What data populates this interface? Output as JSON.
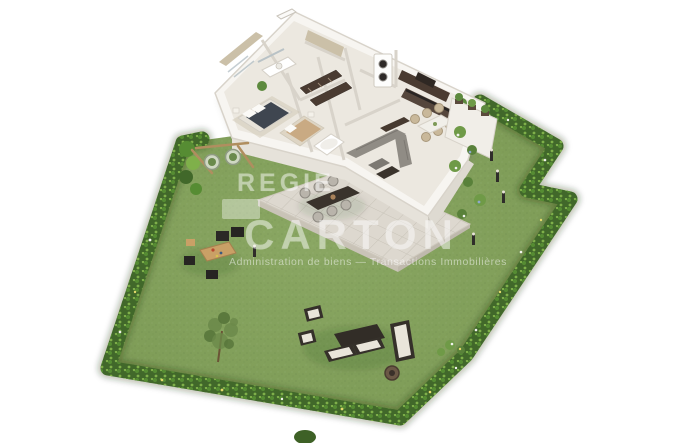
{
  "scene": {
    "title": "3D isometric floor plan render of an apartment with private garden",
    "background": "#ffffff"
  },
  "watermark": {
    "line1": "REGIE",
    "line2": "CARTON",
    "tagline": "Administration de biens — Transactions Immobilières",
    "color": "#ffffff"
  },
  "palette": {
    "pageBg": "#ffffff",
    "grass": "#7f9d58",
    "grassLight": "#8aa763",
    "grassDark": "#6d8c4a",
    "hedge": "#41682a",
    "hedgeMid": "#568c33",
    "hedgeLight": "#7fb04a",
    "wall": "#f7f5f1",
    "wallShade": "#e6e2da",
    "wallLine": "#d8d3ca",
    "floor": "#ece8e0",
    "tile": "#ddd8cf",
    "tileLine": "#c7c2b7",
    "darkWood": "#4a3b31",
    "counterDark": "#3a332c",
    "frameDark": "#35302a",
    "sofaGray": "#908c85",
    "bedDark": "#3f4650",
    "bedBeige": "#c9aa83",
    "cushion": "#e9e5da",
    "woodLight": "#c9a066",
    "plantGreen": "#5d8a3e",
    "treeOlive": "#6c8a4a",
    "flowerWhite": "#f2f4ee",
    "flowerYellow": "#e3d96b",
    "flowerBlue": "#8fa8cc"
  }
}
